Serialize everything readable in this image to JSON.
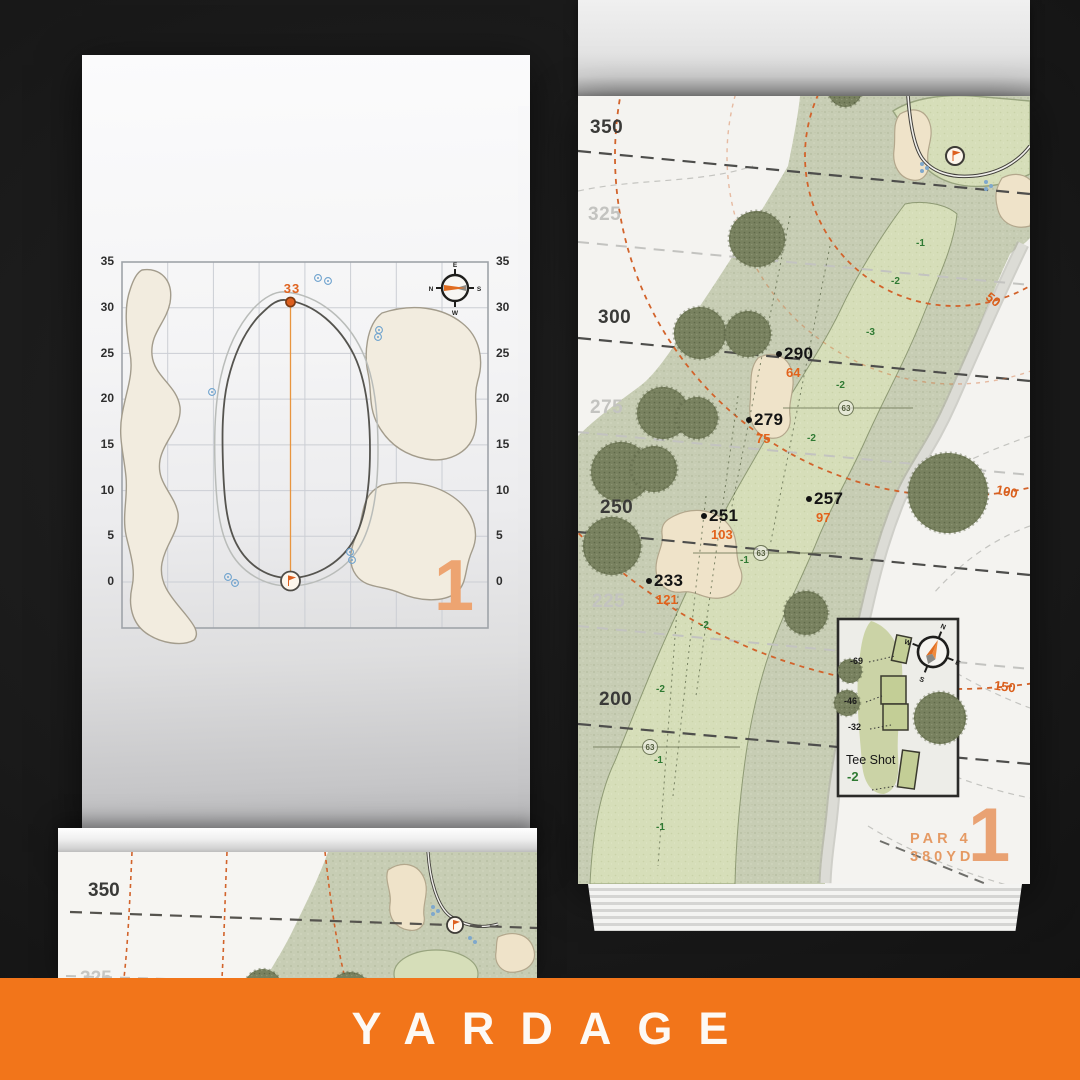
{
  "banner": {
    "label": "YARDAGE",
    "background": "#F2751A",
    "text_color": "#FDF9F4"
  },
  "colors": {
    "accent_orange": "#F2751A",
    "arc_orange": "#D2632B",
    "carry_orange": "#E2621B",
    "elevation_green": "#2F7A33",
    "numeral_salmon": "#E9A273",
    "rough_green": "#C7CDB4",
    "fairway_green": "#D5DDBA",
    "bunker_sand": "#EFE3C9",
    "paper_white": "#F4F3F0"
  },
  "green_page": {
    "page_number": "1",
    "pin_carry": "33",
    "axis_ticks": [
      "35",
      "30",
      "25",
      "20",
      "15",
      "10",
      "5",
      "0"
    ],
    "compass": {
      "n": "N",
      "e": "E",
      "s": "S",
      "w": "W"
    }
  },
  "hole_page": {
    "page_number": "1",
    "par": "PAR 4",
    "yards": "380YD",
    "distance_labels": [
      {
        "text": "350",
        "faded": false
      },
      {
        "text": "325",
        "faded": true
      },
      {
        "text": "300",
        "faded": false
      },
      {
        "text": "275",
        "faded": true
      },
      {
        "text": "250",
        "faded": false
      },
      {
        "text": "225",
        "faded": true
      },
      {
        "text": "200",
        "faded": false
      }
    ],
    "arc_labels": [
      "50",
      "100",
      "150"
    ],
    "carry_points": [
      {
        "carry": "290",
        "remaining": "64"
      },
      {
        "carry": "279",
        "remaining": "75"
      },
      {
        "carry": "257",
        "remaining": "97"
      },
      {
        "carry": "251",
        "remaining": "103"
      },
      {
        "carry": "233",
        "remaining": "121"
      }
    ],
    "sprinkler_numbers": [
      "63",
      "63",
      "63"
    ],
    "elevation_marks": [
      "-1",
      "-2",
      "-3",
      "-2",
      "-2",
      "-1",
      "-2",
      "-2",
      "-1",
      "-1"
    ],
    "tee_inset": {
      "title": "Tee Shot",
      "elevation": "-2",
      "offsets": [
        "-69",
        "-46",
        "-32"
      ]
    },
    "compass": {
      "n": "N",
      "e": "E",
      "s": "S",
      "w": "W"
    }
  },
  "preview_page": {
    "distance_labels": [
      "350",
      "325"
    ]
  }
}
